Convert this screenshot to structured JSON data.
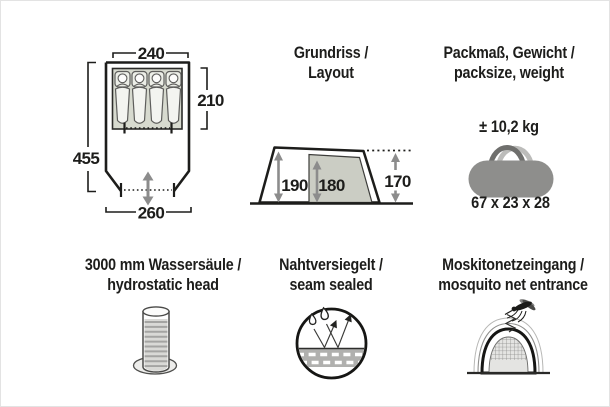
{
  "colors": {
    "ink": "#1d1d1b",
    "arrow_gray": "#8c8c8c",
    "inner_tent_gray": "#cbcdc4",
    "sleep_area_green": "#d7dacf",
    "bag_gray": "#8e8e8c"
  },
  "floorplan": {
    "width_inner": "240",
    "length_inner": "210",
    "length_total": "455",
    "width_front": "260"
  },
  "layout": {
    "title_de": "Grundriss /",
    "title_en": "Layout",
    "height_porch": "190",
    "height_cabin": "180",
    "height_rear": "170"
  },
  "pack": {
    "title_de": "Packmaß, Gewicht /",
    "title_en": "packsize, weight",
    "weight": "± 10,2 kg",
    "size": "67 x 23 x 28"
  },
  "hydrostatic": {
    "title_de": "3000 mm Wassersäule /",
    "title_en": "hydrostatic head"
  },
  "seam": {
    "title_de": "Nahtversiegelt /",
    "title_en": "seam sealed"
  },
  "mosquito": {
    "title_de": "Moskitonetzeingang /",
    "title_en": "mosquito net entrance"
  }
}
